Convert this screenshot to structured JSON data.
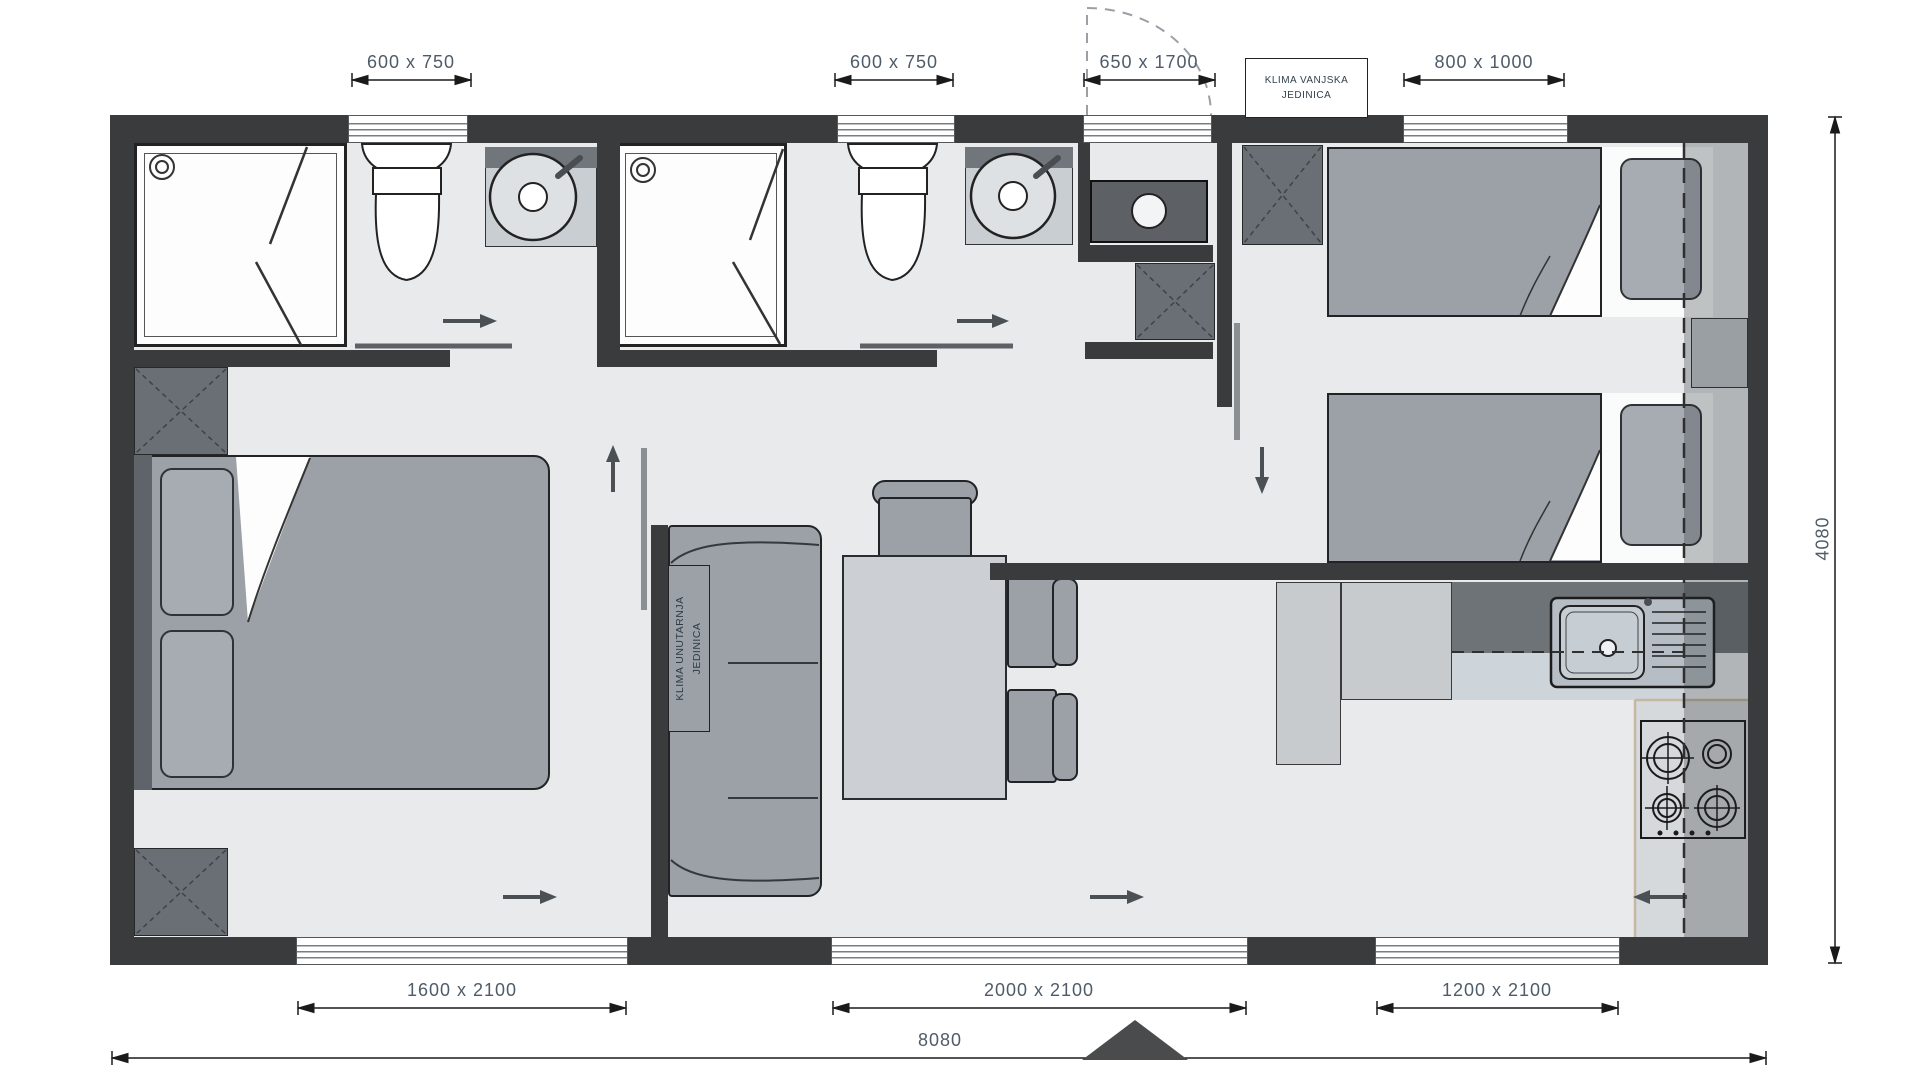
{
  "drawing": {
    "type": "mobile-home floor plan",
    "units": "mm"
  },
  "labels": {
    "ac_outdoor_line1": "KLIMA VANJSKA",
    "ac_outdoor_line2": "JEDINICA",
    "ac_indoor_line1": "KLIMA UNUTARNJA",
    "ac_indoor_line2": "JEDINICA"
  },
  "dimensions": {
    "top": [
      {
        "id": "bathroom1-window",
        "label": "600 x 750"
      },
      {
        "id": "bathroom2-window",
        "label": "600 x 750"
      },
      {
        "id": "technical-door",
        "label": "650 x 1700"
      },
      {
        "id": "bedroom2-window",
        "label": "800 x 1000"
      }
    ],
    "bottom": [
      {
        "id": "bedroom1-patio-door",
        "label": "1600 x 2100"
      },
      {
        "id": "living-patio-door",
        "label": "2000 x 2100"
      },
      {
        "id": "kitchen-window",
        "label": "1200 x 2100"
      }
    ],
    "overall_width": "8080",
    "overall_height": "4080"
  },
  "colors": {
    "wall": "#3a3b3d",
    "floor": "#e8eaec",
    "furniture_mid": "#9ba1a7",
    "furniture_light": "#ccd0d4",
    "furniture_dark": "#6a6f75",
    "dimension_text": "#4e5b68",
    "counter_accent": "#c6b7a1"
  }
}
